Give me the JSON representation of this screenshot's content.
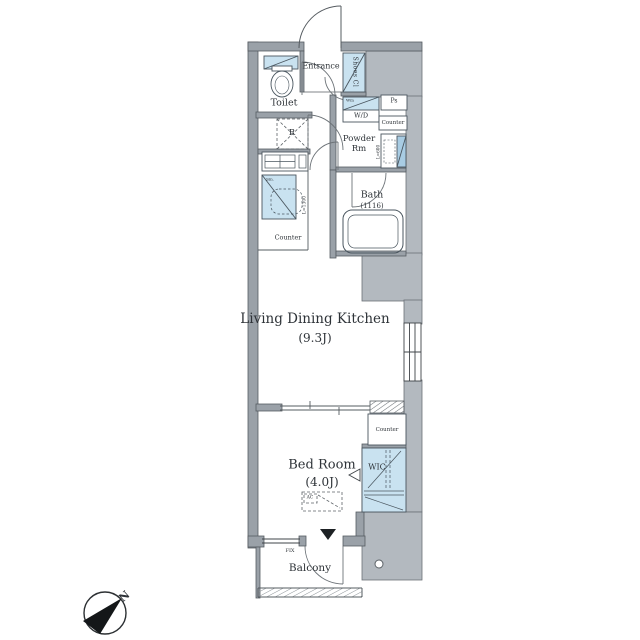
{
  "plan": {
    "labels": {
      "entrance": "Entrance",
      "shoes_closet": "Shoes Cl",
      "toilet": "Toilet",
      "washer_dryer": "W/D",
      "washing_machine": "Wm",
      "pipe_space": "Ps",
      "counter_powder": "Counter",
      "powder_room": "Powder Rm",
      "bath": "Bath",
      "bath_size": "(1116)",
      "refrigerator": "R",
      "sink": "Sin.",
      "counter_kitchen": "Counter",
      "kitchen_counter_length": "L=1300",
      "vanity_length": "L=600",
      "ldk": "Living Dining Kitchen",
      "ldk_size": "(9.3J)",
      "bedroom": "Bed Room",
      "bedroom_size": "(4.0J)",
      "wic": "WIC",
      "counter_bedroom": "Counter",
      "ac": "AC",
      "fix_window": "FIX",
      "balcony": "Balcony",
      "north": "N"
    },
    "colors": {
      "wall": "#9aa1a8",
      "shaded_area": "#b3b9bf",
      "fixture_blue": "#c9e2f0",
      "mirror_blue": "#a8cce3",
      "line": "#3f4448",
      "text": "#2e3338"
    }
  }
}
